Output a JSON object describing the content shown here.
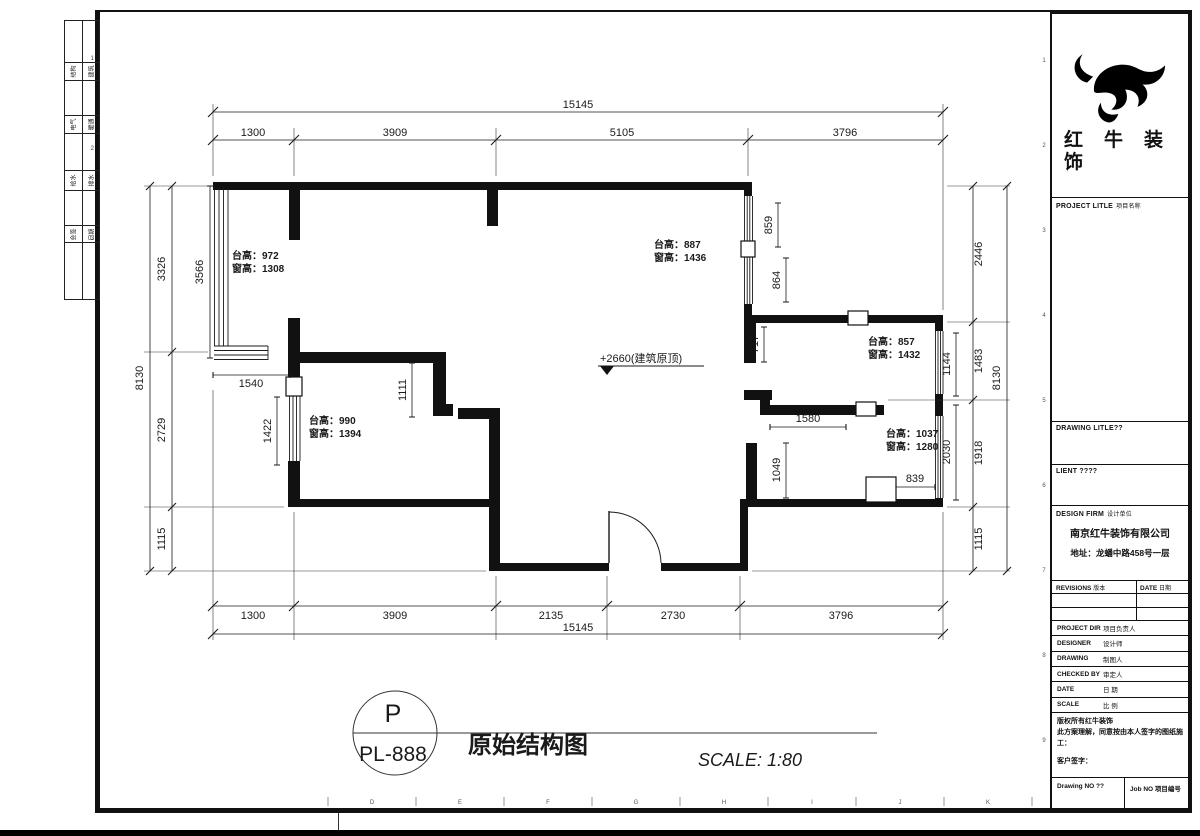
{
  "sheet": {
    "drawing_title": "原始结构图",
    "scale_text": "SCALE: 1:80",
    "stamp_top": "P",
    "stamp_bottom": "PL-888"
  },
  "plan": {
    "elevation_note": "+2660(建筑原顶)",
    "window_notes": [
      {
        "sill": "台高：972",
        "win": "窗高：1308"
      },
      {
        "sill": "台高：887",
        "win": "窗高：1436"
      },
      {
        "sill": "台高：857",
        "win": "窗高：1432"
      },
      {
        "sill": "台高：990",
        "win": "窗高：1394"
      },
      {
        "sill": "台高：1037",
        "win": "窗高：1280"
      }
    ],
    "dims": {
      "top_total": "15145",
      "top": [
        "1300",
        "3909",
        "5105",
        "3796"
      ],
      "bottom": [
        "1300",
        "3909",
        "2135",
        "2730",
        "3796"
      ],
      "bottom_total": "15145",
      "left": [
        "3326",
        "2729",
        "1115"
      ],
      "left_total": "8130",
      "left_inner": [
        "3566",
        "1540",
        "1422",
        "1111"
      ],
      "right": [
        "2446",
        "1483",
        "1918",
        "1115"
      ],
      "right_total": "8130",
      "right_inner": [
        "859",
        "864",
        "717",
        "1144",
        "1580",
        "2030",
        "1049",
        "839"
      ]
    }
  },
  "titleblock": {
    "brand_line1": "红牛装",
    "brand_line2": "饰",
    "project_label": "PROJECT LITLE",
    "project_cn": "项目名称",
    "drawing_label": "DRAWING LITLE??",
    "client_label": "LIENT ????",
    "firm_label": "DESIGN FIRM",
    "firm_cn": "设计单位",
    "firm_name": "南京红牛装饰有限公司",
    "firm_addr": "地址：龙蟠中路458号一层",
    "revisions_label": "REVISIONS",
    "revisions_cn": "版本",
    "date_label": "DATE",
    "date_cn": "日期",
    "staff_rows": [
      {
        "en": "PROJECT DIR",
        "cn": "项目负责人"
      },
      {
        "en": "DESIGNER",
        "cn": "设计师"
      },
      {
        "en": "DRAWING",
        "cn": "制图人"
      },
      {
        "en": "CHECKED BY",
        "cn": "审定人"
      },
      {
        "en": "DATE",
        "cn": "日 期"
      },
      {
        "en": "SCALE",
        "cn": "比 例"
      }
    ],
    "copyright_line1": "版权所有红牛装饰",
    "copyright_line2": "此方案理解，同意按由本人签字的图纸施工：",
    "sign_label": "客户签字：",
    "drawing_no_label": "Drawing NO ??",
    "job_no_label": "Job NO 项目编号"
  },
  "binding_strip": {
    "rows": [
      [
        "结构",
        "建筑"
      ],
      [
        "电气",
        "暖通"
      ],
      [
        "给水",
        "排水"
      ],
      [
        "会签",
        "日期"
      ]
    ]
  },
  "sheet_refs": {
    "bottom": [
      "D",
      "E",
      "F",
      "G",
      "H",
      "I",
      "J",
      "K"
    ],
    "right": [
      "1",
      "2",
      "3",
      "4",
      "5",
      "6",
      "7",
      "8",
      "9"
    ],
    "left": [
      "1",
      "2",
      "3"
    ]
  }
}
